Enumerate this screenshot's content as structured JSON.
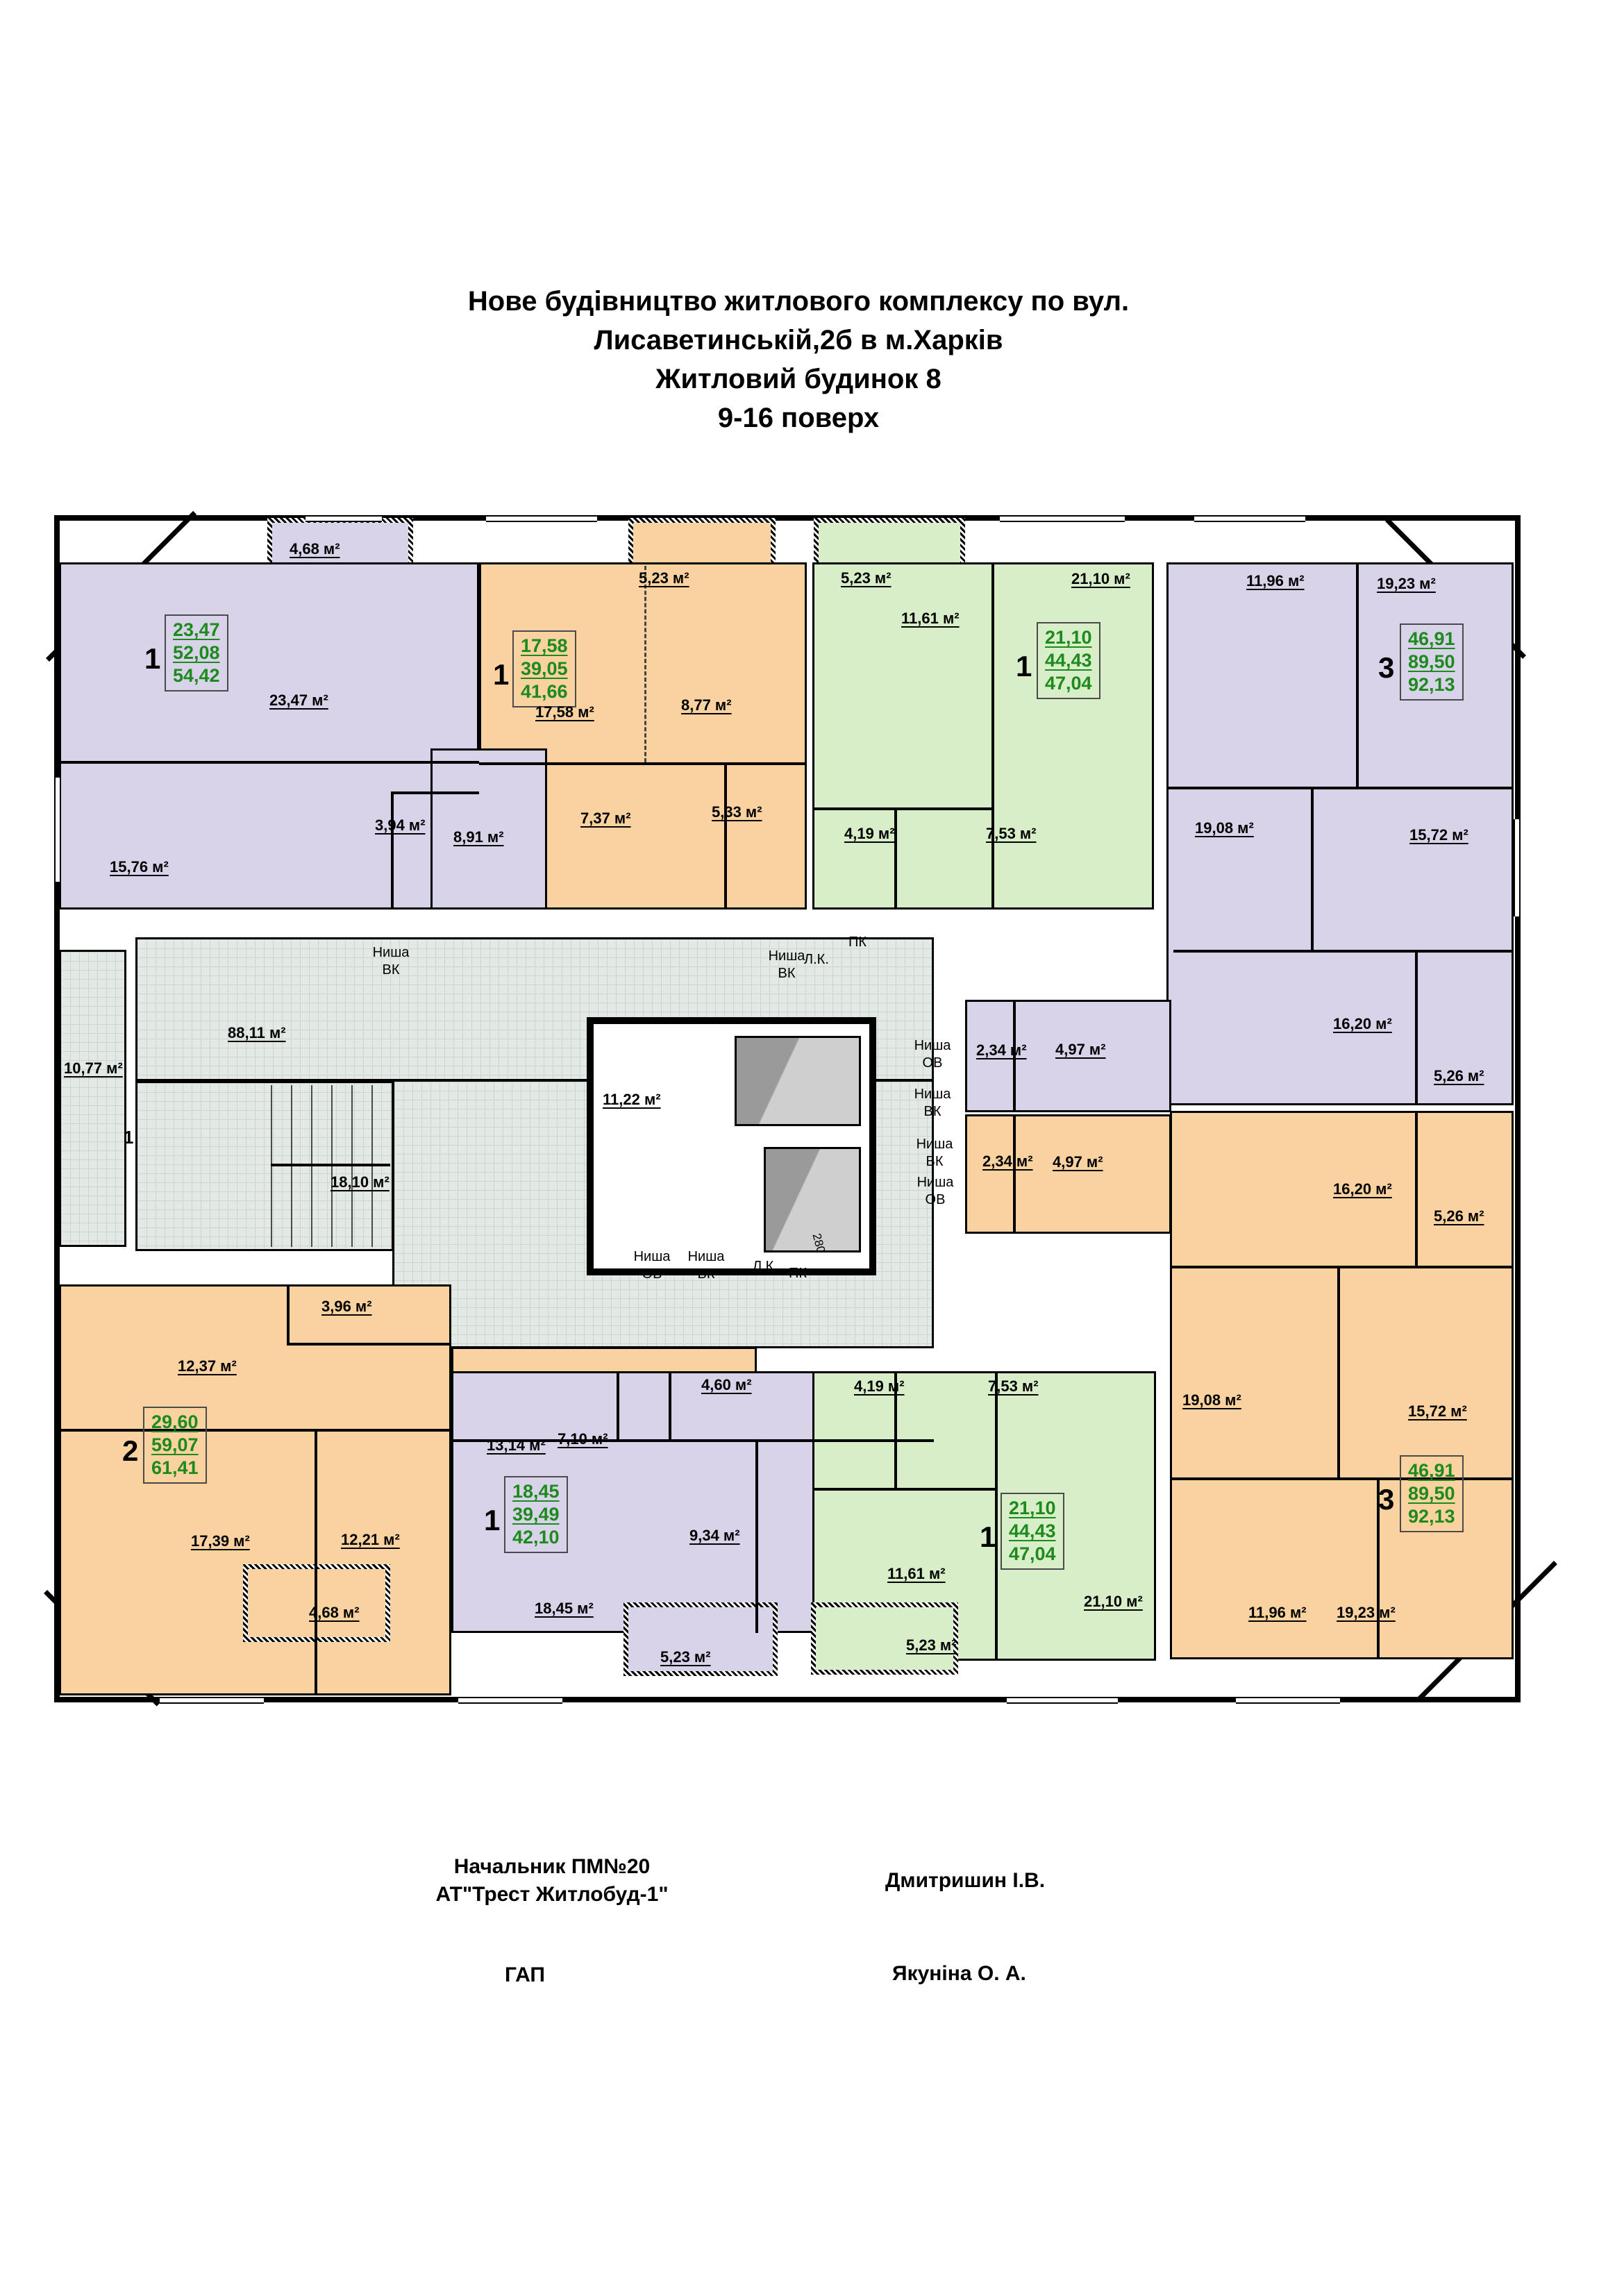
{
  "title": {
    "line1": "Нове будівництво житлового комплексу по вул.",
    "line2": "Лисаветинській,2б в м.Харків",
    "line3": "Житловий будинок 8",
    "line4": "9-16 поверх"
  },
  "footer": {
    "approver_role_line1": "Начальник ПМ№20",
    "approver_role_line2": "АТ\"Трест Житлобуд-1\"",
    "approver_name": "Дмитришин І.В.",
    "architect_role": "ГАП",
    "architect_name": "Якуніна О. А."
  },
  "colors": {
    "apartment_purple": "#d9d3e9",
    "apartment_orange": "#fad2a0",
    "apartment_green": "#d8eec9",
    "common_area": "#e3e9e5",
    "stat_value_green": "#1d8a1d"
  },
  "apartments": [
    {
      "number": "1",
      "living_area": "23,47",
      "heated_area": "52,08",
      "total_area": "54,42"
    },
    {
      "number": "1",
      "living_area": "17,58",
      "heated_area": "39,05",
      "total_area": "41,66"
    },
    {
      "number": "1",
      "living_area": "21,10",
      "heated_area": "44,43",
      "total_area": "47,04"
    },
    {
      "number": "3",
      "living_area": "46,91",
      "heated_area": "89,50",
      "total_area": "92,13"
    },
    {
      "number": "2",
      "living_area": "29,60",
      "heated_area": "59,07",
      "total_area": "61,41"
    },
    {
      "number": "1",
      "living_area": "18,45",
      "heated_area": "39,49",
      "total_area": "42,10"
    },
    {
      "number": "1",
      "living_area": "21,10",
      "heated_area": "44,43",
      "total_area": "47,04"
    },
    {
      "number": "3",
      "living_area": "46,91",
      "heated_area": "89,50",
      "total_area": "92,13"
    }
  ],
  "rooms": [
    "4,68 м²",
    "23,47 м²",
    "15,76 м²",
    "3,94 м²",
    "8,91 м²",
    "5,23 м²",
    "17,58 м²",
    "8,77 м²",
    "7,37 м²",
    "5,33 м²",
    "5,23 м²",
    "11,61 м²",
    "21,10 м²",
    "4,19 м²",
    "7,53 м²",
    "11,96 м²",
    "19,23 м²",
    "19,08 м²",
    "15,72 м²",
    "88,11 м²",
    "10,77 м²",
    "18,10 м²",
    "11,22 м²",
    "2,34 м²",
    "4,97 м²",
    "2,34 м²",
    "4,97 м²",
    "16,20 м²",
    "5,26 м²",
    "16,20 м²",
    "5,26 м²",
    "12,37 м²",
    "3,96 м²",
    "13,14 м²",
    "17,39 м²",
    "12,21 м²",
    "4,68 м²",
    "7,10 м²",
    "4,60 м²",
    "9,34 м²",
    "18,45 м²",
    "5,23 м²",
    "4,19 м²",
    "7,53 м²",
    "11,61 м²",
    "5,23 м²",
    "21,10 м²",
    "19,08 м²",
    "15,72 м²",
    "11,96 м²",
    "19,23 м²"
  ],
  "services": [
    "Ниша ВК",
    "Ниша ВК",
    "Л.К.",
    "ПК",
    "Ниша ОВ",
    "Ниша ВК",
    "Л.К.",
    "ПК",
    "Ниша ОВ",
    "Ниша ВК",
    "Ниша ВК",
    "Ниша ОВ",
    "1",
    "280"
  ]
}
